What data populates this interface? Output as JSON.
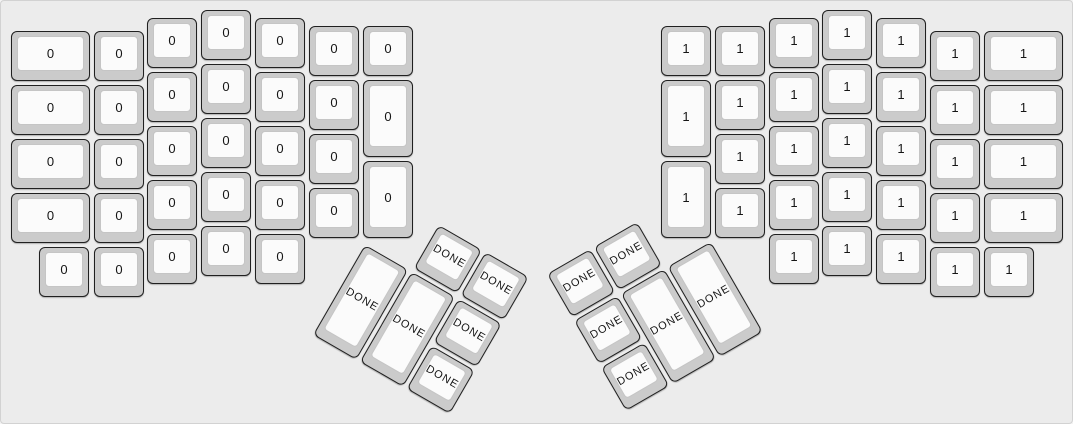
{
  "canvas": {
    "width_px": 1073,
    "height_px": 424,
    "background": "#ececec",
    "border_color": "#d2d2d2"
  },
  "key_style": {
    "cap_color": "#cbcbcb",
    "cap_border_color": "#202020",
    "top_color": "#fbfbfb",
    "top_border_color": "#c5c5c5",
    "label_color": "#151515"
  },
  "legends": {
    "left_half_label": "0",
    "right_half_label": "1",
    "thumb_cluster_label": "DONE"
  },
  "groups": [
    {
      "name": "left-main-group",
      "rotation_deg": 0,
      "origin": {
        "x": 0,
        "y": 0
      },
      "thumb": false,
      "keys": [
        {
          "n": "key-left-c1-r1",
          "l": "0",
          "x": 10,
          "y": 30,
          "w": 79,
          "h": 50
        },
        {
          "n": "key-left-c1-r2",
          "l": "0",
          "x": 10,
          "y": 84,
          "w": 79,
          "h": 50
        },
        {
          "n": "key-left-c1-r3",
          "l": "0",
          "x": 10,
          "y": 138,
          "w": 79,
          "h": 50
        },
        {
          "n": "key-left-c1-r4",
          "l": "0",
          "x": 10,
          "y": 192,
          "w": 79,
          "h": 50
        },
        {
          "n": "key-left-bottomrow-1",
          "l": "0",
          "x": 38,
          "y": 246,
          "w": 50,
          "h": 50
        },
        {
          "n": "key-left-c2-r1",
          "l": "0",
          "x": 93,
          "y": 30,
          "w": 50,
          "h": 50
        },
        {
          "n": "key-left-c2-r2",
          "l": "0",
          "x": 93,
          "y": 84,
          "w": 50,
          "h": 50
        },
        {
          "n": "key-left-c2-r3",
          "l": "0",
          "x": 93,
          "y": 138,
          "w": 50,
          "h": 50
        },
        {
          "n": "key-left-c2-r4",
          "l": "0",
          "x": 93,
          "y": 192,
          "w": 50,
          "h": 50
        },
        {
          "n": "key-left-c2-r5",
          "l": "0",
          "x": 93,
          "y": 246,
          "w": 50,
          "h": 50
        },
        {
          "n": "key-left-c3-r1",
          "l": "0",
          "x": 146,
          "y": 17,
          "w": 50,
          "h": 50
        },
        {
          "n": "key-left-c3-r2",
          "l": "0",
          "x": 146,
          "y": 71,
          "w": 50,
          "h": 50
        },
        {
          "n": "key-left-c3-r3",
          "l": "0",
          "x": 146,
          "y": 125,
          "w": 50,
          "h": 50
        },
        {
          "n": "key-left-c3-r4",
          "l": "0",
          "x": 146,
          "y": 179,
          "w": 50,
          "h": 50
        },
        {
          "n": "key-left-c3-r5",
          "l": "0",
          "x": 146,
          "y": 233,
          "w": 50,
          "h": 50
        },
        {
          "n": "key-left-c4-r1",
          "l": "0",
          "x": 200,
          "y": 9,
          "w": 50,
          "h": 50
        },
        {
          "n": "key-left-c4-r2",
          "l": "0",
          "x": 200,
          "y": 63,
          "w": 50,
          "h": 50
        },
        {
          "n": "key-left-c4-r3",
          "l": "0",
          "x": 200,
          "y": 117,
          "w": 50,
          "h": 50
        },
        {
          "n": "key-left-c4-r4",
          "l": "0",
          "x": 200,
          "y": 171,
          "w": 50,
          "h": 50
        },
        {
          "n": "key-left-c4-r5",
          "l": "0",
          "x": 200,
          "y": 225,
          "w": 50,
          "h": 50
        },
        {
          "n": "key-left-c5-r1",
          "l": "0",
          "x": 254,
          "y": 17,
          "w": 50,
          "h": 50
        },
        {
          "n": "key-left-c5-r2",
          "l": "0",
          "x": 254,
          "y": 71,
          "w": 50,
          "h": 50
        },
        {
          "n": "key-left-c5-r3",
          "l": "0",
          "x": 254,
          "y": 125,
          "w": 50,
          "h": 50
        },
        {
          "n": "key-left-c5-r4",
          "l": "0",
          "x": 254,
          "y": 179,
          "w": 50,
          "h": 50
        },
        {
          "n": "key-left-c5-r5",
          "l": "0",
          "x": 254,
          "y": 233,
          "w": 50,
          "h": 50
        },
        {
          "n": "key-left-c6-r1",
          "l": "0",
          "x": 308,
          "y": 25,
          "w": 50,
          "h": 50
        },
        {
          "n": "key-left-c6-r2",
          "l": "0",
          "x": 308,
          "y": 79,
          "w": 50,
          "h": 50
        },
        {
          "n": "key-left-c6-r3",
          "l": "0",
          "x": 308,
          "y": 133,
          "w": 50,
          "h": 50
        },
        {
          "n": "key-left-c6-r4",
          "l": "0",
          "x": 308,
          "y": 187,
          "w": 50,
          "h": 50
        },
        {
          "n": "key-left-c7-r1",
          "l": "0",
          "x": 362,
          "y": 25,
          "w": 50,
          "h": 50
        },
        {
          "n": "key-left-c7-tall1",
          "l": "0",
          "x": 362,
          "y": 79,
          "w": 50,
          "h": 77
        },
        {
          "n": "key-left-c7-tall2",
          "l": "0",
          "x": 362,
          "y": 160,
          "w": 50,
          "h": 77
        }
      ]
    },
    {
      "name": "left-thumb-group",
      "rotation_deg": 30,
      "origin": {
        "x": 391,
        "y": 197
      },
      "thumb": true,
      "keys": [
        {
          "n": "key-left-thumb-top1",
          "l": "DONE",
          "x": 54,
          "y": 0,
          "w": 50,
          "h": 50
        },
        {
          "n": "key-left-thumb-top2",
          "l": "DONE",
          "x": 108,
          "y": 0,
          "w": 50,
          "h": 50
        },
        {
          "n": "key-left-thumb-tall1",
          "l": "DONE",
          "x": 0,
          "y": 54,
          "w": 50,
          "h": 104
        },
        {
          "n": "key-left-thumb-tall2",
          "l": "DONE",
          "x": 54,
          "y": 54,
          "w": 50,
          "h": 104
        },
        {
          "n": "key-left-thumb-mid",
          "l": "DONE",
          "x": 108,
          "y": 54,
          "w": 50,
          "h": 50
        },
        {
          "n": "key-left-thumb-bottom",
          "l": "DONE",
          "x": 108,
          "y": 108,
          "w": 50,
          "h": 50
        }
      ]
    },
    {
      "name": "right-main-group",
      "rotation_deg": 0,
      "origin": {
        "x": 0,
        "y": 0
      },
      "thumb": false,
      "keys": [
        {
          "n": "key-right-c1-r1",
          "l": "1",
          "x": 660,
          "y": 25,
          "w": 50,
          "h": 50
        },
        {
          "n": "key-right-c1-tall1",
          "l": "1",
          "x": 660,
          "y": 79,
          "w": 50,
          "h": 77
        },
        {
          "n": "key-right-c1-tall2",
          "l": "1",
          "x": 660,
          "y": 160,
          "w": 50,
          "h": 77
        },
        {
          "n": "key-right-c2-r1",
          "l": "1",
          "x": 714,
          "y": 25,
          "w": 50,
          "h": 50
        },
        {
          "n": "key-right-c2-r2",
          "l": "1",
          "x": 714,
          "y": 79,
          "w": 50,
          "h": 50
        },
        {
          "n": "key-right-c2-r3",
          "l": "1",
          "x": 714,
          "y": 133,
          "w": 50,
          "h": 50
        },
        {
          "n": "key-right-c2-r4",
          "l": "1",
          "x": 714,
          "y": 187,
          "w": 50,
          "h": 50
        },
        {
          "n": "key-right-c3-r1",
          "l": "1",
          "x": 768,
          "y": 17,
          "w": 50,
          "h": 50
        },
        {
          "n": "key-right-c3-r2",
          "l": "1",
          "x": 768,
          "y": 71,
          "w": 50,
          "h": 50
        },
        {
          "n": "key-right-c3-r3",
          "l": "1",
          "x": 768,
          "y": 125,
          "w": 50,
          "h": 50
        },
        {
          "n": "key-right-c3-r4",
          "l": "1",
          "x": 768,
          "y": 179,
          "w": 50,
          "h": 50
        },
        {
          "n": "key-right-c3-r5",
          "l": "1",
          "x": 768,
          "y": 233,
          "w": 50,
          "h": 50
        },
        {
          "n": "key-right-c4-r1",
          "l": "1",
          "x": 821,
          "y": 9,
          "w": 50,
          "h": 50
        },
        {
          "n": "key-right-c4-r2",
          "l": "1",
          "x": 821,
          "y": 63,
          "w": 50,
          "h": 50
        },
        {
          "n": "key-right-c4-r3",
          "l": "1",
          "x": 821,
          "y": 117,
          "w": 50,
          "h": 50
        },
        {
          "n": "key-right-c4-r4",
          "l": "1",
          "x": 821,
          "y": 171,
          "w": 50,
          "h": 50
        },
        {
          "n": "key-right-c4-r5",
          "l": "1",
          "x": 821,
          "y": 225,
          "w": 50,
          "h": 50
        },
        {
          "n": "key-right-c5-r1",
          "l": "1",
          "x": 875,
          "y": 17,
          "w": 50,
          "h": 50
        },
        {
          "n": "key-right-c5-r2",
          "l": "1",
          "x": 875,
          "y": 71,
          "w": 50,
          "h": 50
        },
        {
          "n": "key-right-c5-r3",
          "l": "1",
          "x": 875,
          "y": 125,
          "w": 50,
          "h": 50
        },
        {
          "n": "key-right-c5-r4",
          "l": "1",
          "x": 875,
          "y": 179,
          "w": 50,
          "h": 50
        },
        {
          "n": "key-right-c5-r5",
          "l": "1",
          "x": 875,
          "y": 233,
          "w": 50,
          "h": 50
        },
        {
          "n": "key-right-c6-r1",
          "l": "1",
          "x": 929,
          "y": 30,
          "w": 50,
          "h": 50
        },
        {
          "n": "key-right-c6-r2",
          "l": "1",
          "x": 929,
          "y": 84,
          "w": 50,
          "h": 50
        },
        {
          "n": "key-right-c6-r3",
          "l": "1",
          "x": 929,
          "y": 138,
          "w": 50,
          "h": 50
        },
        {
          "n": "key-right-c6-r4",
          "l": "1",
          "x": 929,
          "y": 192,
          "w": 50,
          "h": 50
        },
        {
          "n": "key-right-c6-r5",
          "l": "1",
          "x": 929,
          "y": 246,
          "w": 50,
          "h": 50
        },
        {
          "n": "key-right-c7-r1",
          "l": "1",
          "x": 983,
          "y": 30,
          "w": 79,
          "h": 50
        },
        {
          "n": "key-right-c7-r2",
          "l": "1",
          "x": 983,
          "y": 84,
          "w": 79,
          "h": 50
        },
        {
          "n": "key-right-c7-r3",
          "l": "1",
          "x": 983,
          "y": 138,
          "w": 79,
          "h": 50
        },
        {
          "n": "key-right-c7-r4",
          "l": "1",
          "x": 983,
          "y": 192,
          "w": 79,
          "h": 50
        },
        {
          "n": "key-right-bottomrow-5",
          "l": "1",
          "x": 983,
          "y": 246,
          "w": 50,
          "h": 50
        }
      ]
    },
    {
      "name": "right-thumb-group",
      "rotation_deg": -30,
      "origin": {
        "x": 546,
        "y": 273
      },
      "thumb": true,
      "keys": [
        {
          "n": "key-right-thumb-top1",
          "l": "DONE",
          "x": 0,
          "y": 0,
          "w": 50,
          "h": 50
        },
        {
          "n": "key-right-thumb-top2",
          "l": "DONE",
          "x": 54,
          "y": 0,
          "w": 50,
          "h": 50
        },
        {
          "n": "key-right-thumb-mid",
          "l": "DONE",
          "x": 0,
          "y": 54,
          "w": 50,
          "h": 50
        },
        {
          "n": "key-right-thumb-tall1",
          "l": "DONE",
          "x": 54,
          "y": 54,
          "w": 50,
          "h": 104
        },
        {
          "n": "key-right-thumb-tall2",
          "l": "DONE",
          "x": 108,
          "y": 54,
          "w": 50,
          "h": 104
        },
        {
          "n": "key-right-thumb-bottom",
          "l": "DONE",
          "x": 0,
          "y": 108,
          "w": 50,
          "h": 50
        }
      ]
    }
  ]
}
